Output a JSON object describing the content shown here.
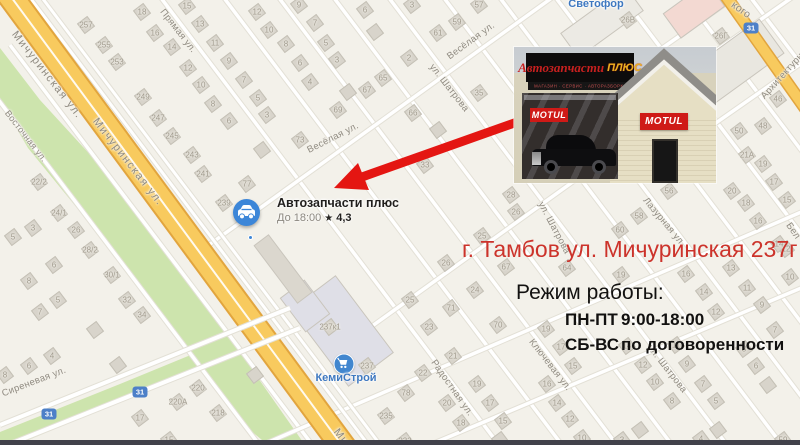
{
  "colors": {
    "accent_red": "#e41612",
    "address_red": "#cc332b",
    "marker_blue": "#3c86d8",
    "poi_blue": "#3e78c0",
    "road_yellow": "#f8ca5e",
    "road_casing": "#e2a53e",
    "green": "#cde4ad",
    "map_bg": "#f3f1ea"
  },
  "marker": {
    "title": "Автозапчасти плюс",
    "hours": "До 18:00",
    "star": "★",
    "rating": "4,3"
  },
  "photo": {
    "sign_line1": "Автозапчасти",
    "sign_accent": "ПЛЮС",
    "sign_sub": "МАГАЗИН · СЕРВИС · АВТОРАЗБОРКА",
    "brand": "MOTUL"
  },
  "annotations": {
    "address": "г. Тамбов ул. Мичуринская 237г",
    "schedule_title": "Режим работы:",
    "rows": [
      {
        "days": "ПН-ПТ",
        "hours": "9:00-18:00"
      },
      {
        "days": "СБ-ВС",
        "hours": "по договоренности"
      }
    ]
  },
  "map": {
    "pois": [
      {
        "name": "Светофор",
        "x": 596,
        "y": -2
      },
      {
        "name": "КемиСтрой",
        "x": 346,
        "y": 372,
        "icon": "cart",
        "ix": 344,
        "iy": 364
      }
    ],
    "shields": [
      {
        "t": "31",
        "x": 751,
        "y": 28
      },
      {
        "t": "31",
        "x": 140,
        "y": 392
      },
      {
        "t": "31",
        "x": 49,
        "y": 414
      }
    ],
    "streets": [
      {
        "t": "Мичуринская ул.",
        "x": 47,
        "y": 75,
        "r": 52,
        "s": 11,
        "ls": 1.5
      },
      {
        "t": "Мичуринская ул.",
        "x": 128,
        "y": 162,
        "r": 52,
        "s": 11,
        "ls": 1.5
      },
      {
        "t": "Ми",
        "x": 341,
        "y": 437,
        "r": 52,
        "s": 11,
        "ls": 1
      },
      {
        "t": "Восточная ул.",
        "x": 26,
        "y": 136,
        "r": 52,
        "s": 9
      },
      {
        "t": "Прямая ул.",
        "x": 178,
        "y": 31,
        "r": 52,
        "s": 9.5
      },
      {
        "t": "Весёлая ул.",
        "x": 471,
        "y": 41,
        "r": -36,
        "s": 9.5
      },
      {
        "t": "Весёлая ул.",
        "x": 333,
        "y": 138,
        "r": -27,
        "s": 9.5
      },
      {
        "t": "ул. Шатрова",
        "x": 449,
        "y": 88,
        "r": 52,
        "s": 9.5
      },
      {
        "t": "ул. Шатрова",
        "x": 554,
        "y": 228,
        "r": 62,
        "s": 9.5
      },
      {
        "t": "ул. Шатрова",
        "x": 667,
        "y": 369,
        "r": 52,
        "s": 9.5
      },
      {
        "t": "Лазурная ул.",
        "x": 664,
        "y": 222,
        "r": 50,
        "s": 9.5
      },
      {
        "t": "Радостная ул.",
        "x": 452,
        "y": 388,
        "r": 55,
        "s": 9.5
      },
      {
        "t": "Сиреневая ул.",
        "x": 34,
        "y": 382,
        "r": -21,
        "s": 9.5
      },
      {
        "t": "Ключевая ул.",
        "x": 550,
        "y": 365,
        "r": 52,
        "s": 9.5
      },
      {
        "t": "Архитектурная",
        "x": 786,
        "y": 72,
        "r": -48,
        "s": 9.5
      },
      {
        "t": "кого",
        "x": 741,
        "y": 10,
        "r": 35,
        "s": 10.5
      },
      {
        "t": "Бел",
        "x": 793,
        "y": 231,
        "r": 55,
        "s": 9.5
      }
    ],
    "numbers": [
      {
        "n": "257",
        "x": 86,
        "y": 25
      },
      {
        "n": "255",
        "x": 104,
        "y": 45
      },
      {
        "n": "253",
        "x": 117,
        "y": 62
      },
      {
        "n": "249",
        "x": 143,
        "y": 97
      },
      {
        "n": "247",
        "x": 158,
        "y": 118
      },
      {
        "n": "245",
        "x": 172,
        "y": 136
      },
      {
        "n": "243",
        "x": 192,
        "y": 155
      },
      {
        "n": "241",
        "x": 203,
        "y": 174
      },
      {
        "n": "239",
        "x": 224,
        "y": 203
      },
      {
        "n": "237к1",
        "x": 330,
        "y": 327
      },
      {
        "n": "237",
        "x": 367,
        "y": 366
      },
      {
        "n": "235",
        "x": 386,
        "y": 416
      },
      {
        "n": "233",
        "x": 405,
        "y": 441
      },
      {
        "n": "77",
        "x": 247,
        "y": 184
      },
      {
        "n": "73",
        "x": 300,
        "y": 140
      },
      {
        "n": "69",
        "x": 338,
        "y": 110
      },
      {
        "n": "67",
        "x": 367,
        "y": 90
      },
      {
        "n": "65",
        "x": 383,
        "y": 78
      },
      {
        "n": "66",
        "x": 413,
        "y": 113
      },
      {
        "n": "33",
        "x": 425,
        "y": 165
      },
      {
        "n": "35",
        "x": 479,
        "y": 93
      },
      {
        "n": "78",
        "x": 406,
        "y": 393
      },
      {
        "n": "18",
        "x": 142,
        "y": 12
      },
      {
        "n": "16",
        "x": 155,
        "y": 33
      },
      {
        "n": "14",
        "x": 172,
        "y": 47
      },
      {
        "n": "12",
        "x": 188,
        "y": 68
      },
      {
        "n": "10",
        "x": 201,
        "y": 85
      },
      {
        "n": "8",
        "x": 213,
        "y": 104
      },
      {
        "n": "6",
        "x": 229,
        "y": 121
      },
      {
        "n": "15",
        "x": 187,
        "y": 6
      },
      {
        "n": "13",
        "x": 200,
        "y": 24
      },
      {
        "n": "11",
        "x": 215,
        "y": 43
      },
      {
        "n": "9",
        "x": 229,
        "y": 61
      },
      {
        "n": "7",
        "x": 244,
        "y": 80
      },
      {
        "n": "5",
        "x": 258,
        "y": 98
      },
      {
        "n": "12",
        "x": 257,
        "y": 12
      },
      {
        "n": "10",
        "x": 269,
        "y": 30
      },
      {
        "n": "8",
        "x": 286,
        "y": 44
      },
      {
        "n": "6",
        "x": 300,
        "y": 63
      },
      {
        "n": "4",
        "x": 310,
        "y": 82
      },
      {
        "n": "3",
        "x": 267,
        "y": 115
      },
      {
        "n": "9",
        "x": 299,
        "y": 5
      },
      {
        "n": "7",
        "x": 315,
        "y": 23
      },
      {
        "n": "5",
        "x": 326,
        "y": 43
      },
      {
        "n": "3",
        "x": 337,
        "y": 60
      },
      {
        "n": "6",
        "x": 365,
        "y": 10
      },
      {
        "n": "3",
        "x": 412,
        "y": 5
      },
      {
        "n": "2",
        "x": 409,
        "y": 58
      },
      {
        "n": "57",
        "x": 479,
        "y": 5
      },
      {
        "n": "59",
        "x": 457,
        "y": 22
      },
      {
        "n": "61",
        "x": 438,
        "y": 33
      },
      {
        "n": "22/2",
        "x": 39,
        "y": 182
      },
      {
        "n": "24/1",
        "x": 59,
        "y": 213
      },
      {
        "n": "26",
        "x": 76,
        "y": 230
      },
      {
        "n": "28/2",
        "x": 90,
        "y": 250
      },
      {
        "n": "30/1",
        "x": 112,
        "y": 275
      },
      {
        "n": "3",
        "x": 33,
        "y": 228
      },
      {
        "n": "5",
        "x": 13,
        "y": 237
      },
      {
        "n": "6",
        "x": 54,
        "y": 265
      },
      {
        "n": "8",
        "x": 29,
        "y": 281
      },
      {
        "n": "32",
        "x": 127,
        "y": 300
      },
      {
        "n": "34",
        "x": 142,
        "y": 315
      },
      {
        "n": "4",
        "x": 52,
        "y": 356
      },
      {
        "n": "6",
        "x": 29,
        "y": 366
      },
      {
        "n": "8",
        "x": 5,
        "y": 375
      },
      {
        "n": "5",
        "x": 58,
        "y": 300
      },
      {
        "n": "7",
        "x": 40,
        "y": 312
      },
      {
        "n": "17",
        "x": 140,
        "y": 418
      },
      {
        "n": "15",
        "x": 169,
        "y": 440
      },
      {
        "n": "220",
        "x": 198,
        "y": 388
      },
      {
        "n": "220А",
        "x": 178,
        "y": 402
      },
      {
        "n": "218",
        "x": 218,
        "y": 413
      },
      {
        "n": "25",
        "x": 410,
        "y": 300
      },
      {
        "n": "23",
        "x": 429,
        "y": 327
      },
      {
        "n": "71",
        "x": 451,
        "y": 308
      },
      {
        "n": "70",
        "x": 498,
        "y": 325
      },
      {
        "n": "21",
        "x": 453,
        "y": 356
      },
      {
        "n": "22",
        "x": 423,
        "y": 373
      },
      {
        "n": "19",
        "x": 477,
        "y": 384
      },
      {
        "n": "20",
        "x": 447,
        "y": 403
      },
      {
        "n": "17",
        "x": 490,
        "y": 403
      },
      {
        "n": "18",
        "x": 461,
        "y": 423
      },
      {
        "n": "15",
        "x": 503,
        "y": 421
      },
      {
        "n": "28",
        "x": 511,
        "y": 195
      },
      {
        "n": "26",
        "x": 516,
        "y": 212
      },
      {
        "n": "25",
        "x": 482,
        "y": 236
      },
      {
        "n": "26",
        "x": 446,
        "y": 263
      },
      {
        "n": "24",
        "x": 475,
        "y": 290
      },
      {
        "n": "67",
        "x": 506,
        "y": 267
      },
      {
        "n": "64",
        "x": 567,
        "y": 268
      },
      {
        "n": "60",
        "x": 620,
        "y": 230
      },
      {
        "n": "58",
        "x": 639,
        "y": 216
      },
      {
        "n": "56",
        "x": 669,
        "y": 191
      },
      {
        "n": "19",
        "x": 621,
        "y": 275
      },
      {
        "n": "19",
        "x": 546,
        "y": 329
      },
      {
        "n": "17",
        "x": 561,
        "y": 347
      },
      {
        "n": "15",
        "x": 573,
        "y": 366
      },
      {
        "n": "16",
        "x": 547,
        "y": 384
      },
      {
        "n": "14",
        "x": 557,
        "y": 403
      },
      {
        "n": "12",
        "x": 570,
        "y": 419
      },
      {
        "n": "10",
        "x": 582,
        "y": 438
      },
      {
        "n": "14",
        "x": 627,
        "y": 346
      },
      {
        "n": "12",
        "x": 643,
        "y": 365
      },
      {
        "n": "10",
        "x": 655,
        "y": 382
      },
      {
        "n": "8",
        "x": 672,
        "y": 401
      },
      {
        "n": "11",
        "x": 676,
        "y": 345
      },
      {
        "n": "9",
        "x": 687,
        "y": 364
      },
      {
        "n": "7",
        "x": 703,
        "y": 384
      },
      {
        "n": "5",
        "x": 716,
        "y": 401
      },
      {
        "n": "13",
        "x": 731,
        "y": 268
      },
      {
        "n": "11",
        "x": 747,
        "y": 288
      },
      {
        "n": "9",
        "x": 762,
        "y": 305
      },
      {
        "n": "12",
        "x": 716,
        "y": 312
      },
      {
        "n": "14",
        "x": 704,
        "y": 292
      },
      {
        "n": "16",
        "x": 686,
        "y": 274
      },
      {
        "n": "8",
        "x": 744,
        "y": 349
      },
      {
        "n": "6",
        "x": 756,
        "y": 366
      },
      {
        "n": "12",
        "x": 786,
        "y": 249
      },
      {
        "n": "14",
        "x": 779,
        "y": 244
      },
      {
        "n": "15",
        "x": 787,
        "y": 200
      },
      {
        "n": "16",
        "x": 758,
        "y": 221
      },
      {
        "n": "18",
        "x": 746,
        "y": 203
      },
      {
        "n": "20",
        "x": 732,
        "y": 191
      },
      {
        "n": "17",
        "x": 774,
        "y": 182
      },
      {
        "n": "19",
        "x": 763,
        "y": 164
      },
      {
        "n": "21А",
        "x": 747,
        "y": 155
      },
      {
        "n": "50",
        "x": 739,
        "y": 131
      },
      {
        "n": "48",
        "x": 763,
        "y": 126
      },
      {
        "n": "46",
        "x": 778,
        "y": 99
      },
      {
        "n": "26В",
        "x": 628,
        "y": 20
      },
      {
        "n": "26Г",
        "x": 721,
        "y": 36
      },
      {
        "n": "59",
        "x": 783,
        "y": 440
      },
      {
        "n": "4",
        "x": 701,
        "y": 439
      },
      {
        "n": "3",
        "x": 622,
        "y": 440
      },
      {
        "n": "10",
        "x": 790,
        "y": 277
      },
      {
        "n": "7",
        "x": 775,
        "y": 330
      },
      {
        "n": "",
        "x": 375,
        "y": 32
      },
      {
        "n": "",
        "x": 348,
        "y": 92
      },
      {
        "n": "",
        "x": 262,
        "y": 150
      },
      {
        "n": "",
        "x": 438,
        "y": 130
      },
      {
        "n": "",
        "x": 95,
        "y": 330
      },
      {
        "n": "",
        "x": 118,
        "y": 365
      },
      {
        "n": "",
        "x": 255,
        "y": 375
      },
      {
        "n": "",
        "x": 768,
        "y": 385
      },
      {
        "n": "",
        "x": 718,
        "y": 430
      },
      {
        "n": "",
        "x": 640,
        "y": 430
      },
      {
        "n": "",
        "x": 500,
        "y": 440
      }
    ]
  }
}
